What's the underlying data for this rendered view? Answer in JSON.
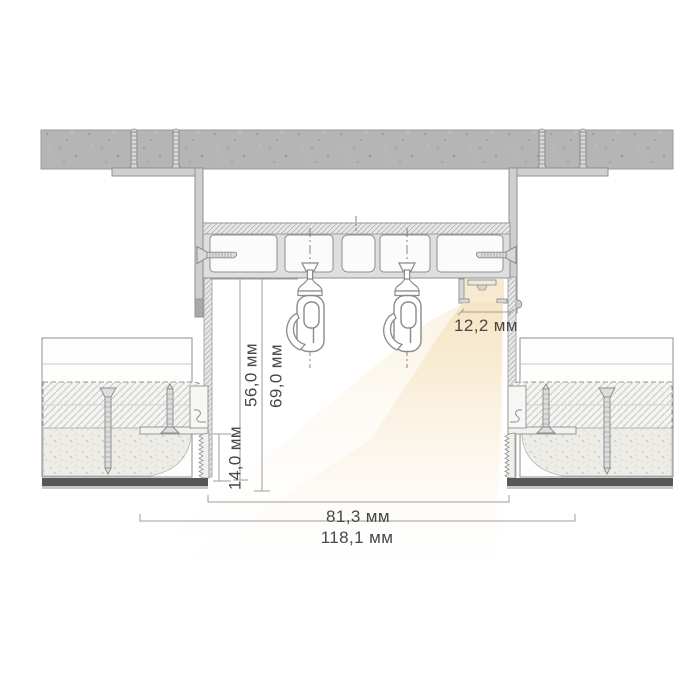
{
  "diagram": {
    "kind": "curtain-niche-cross-section",
    "dimensions": {
      "niche_inner_height": "56,0 мм",
      "niche_total_height": "69,0 мм",
      "ceiling_edge_height": "14,0 мм",
      "led_profile_width": "12,2 мм",
      "niche_opening_width": "81,3 мм",
      "niche_total_width": "118,1 мм"
    },
    "colors": {
      "concrete": "#b5b5b5",
      "outline": "#8f8f8f",
      "warm_light": "#f6e3c0",
      "warm_light_mid": "#f8ecd6",
      "glow_core": "#f8ead0",
      "text": "#474747",
      "dim_line": "#9c9c9c",
      "dark_edge": "#575757",
      "metal": "#d8d8d8",
      "background": "#ffffff"
    }
  }
}
